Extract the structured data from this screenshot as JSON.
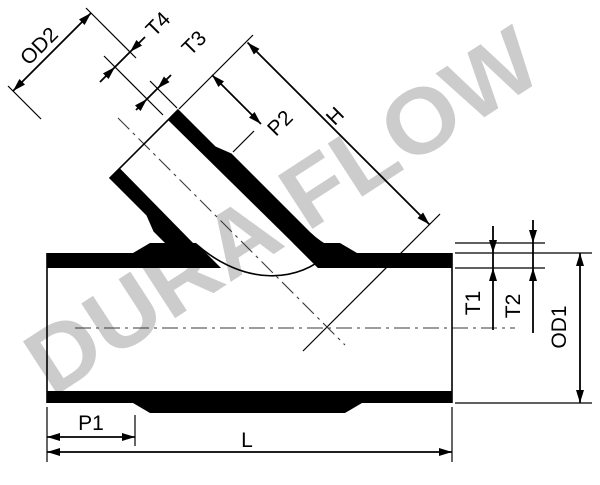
{
  "drawing": {
    "type": "technical-drawing",
    "subject": "45-degree lateral wye pipe fitting, section view",
    "line_color": "#000000",
    "background_color": "#ffffff"
  },
  "watermark": {
    "text": "DURA FLOW",
    "color": "#cccccc"
  },
  "dimension_labels": {
    "od2": "OD2",
    "t4": "T4",
    "t3": "T3",
    "p2": "P2",
    "h": "H",
    "t1": "T1",
    "t2": "T2",
    "od1": "OD1",
    "p1": "P1",
    "l": "L"
  }
}
